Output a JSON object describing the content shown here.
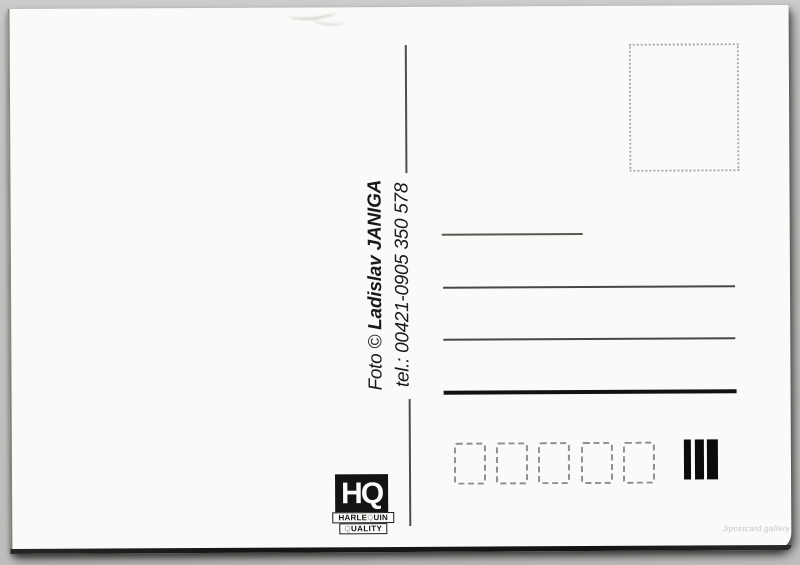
{
  "scan": {
    "background_color": "#c3c3c1",
    "card_color": "#fafaf8",
    "watermark_text": "Jlpostcard.gallery"
  },
  "postcard": {
    "credit_prefix": "Foto ©",
    "photographer_name": "Ladislav JANIGA",
    "phone_line": "tel.: 00421-0905 350 578",
    "logo": {
      "initials": "HQ",
      "brand_before": "HARLE",
      "brand_q": "Q",
      "brand_after": "UIN",
      "quality_q": "Q",
      "quality_rest": "UALITY"
    },
    "address_line_count": 4,
    "postcode_box_count": 5,
    "franking_bar_count": 3,
    "colors": {
      "rule_thin": "#4a4846",
      "rule_thick": "#141210",
      "franking_bar": "#0c0c0a",
      "stamp_border": "#a5a5a3",
      "postcode_border": "#8f8f8d",
      "credit_text": "#1b1917",
      "bottom_edge_shadow": "#161614"
    }
  }
}
